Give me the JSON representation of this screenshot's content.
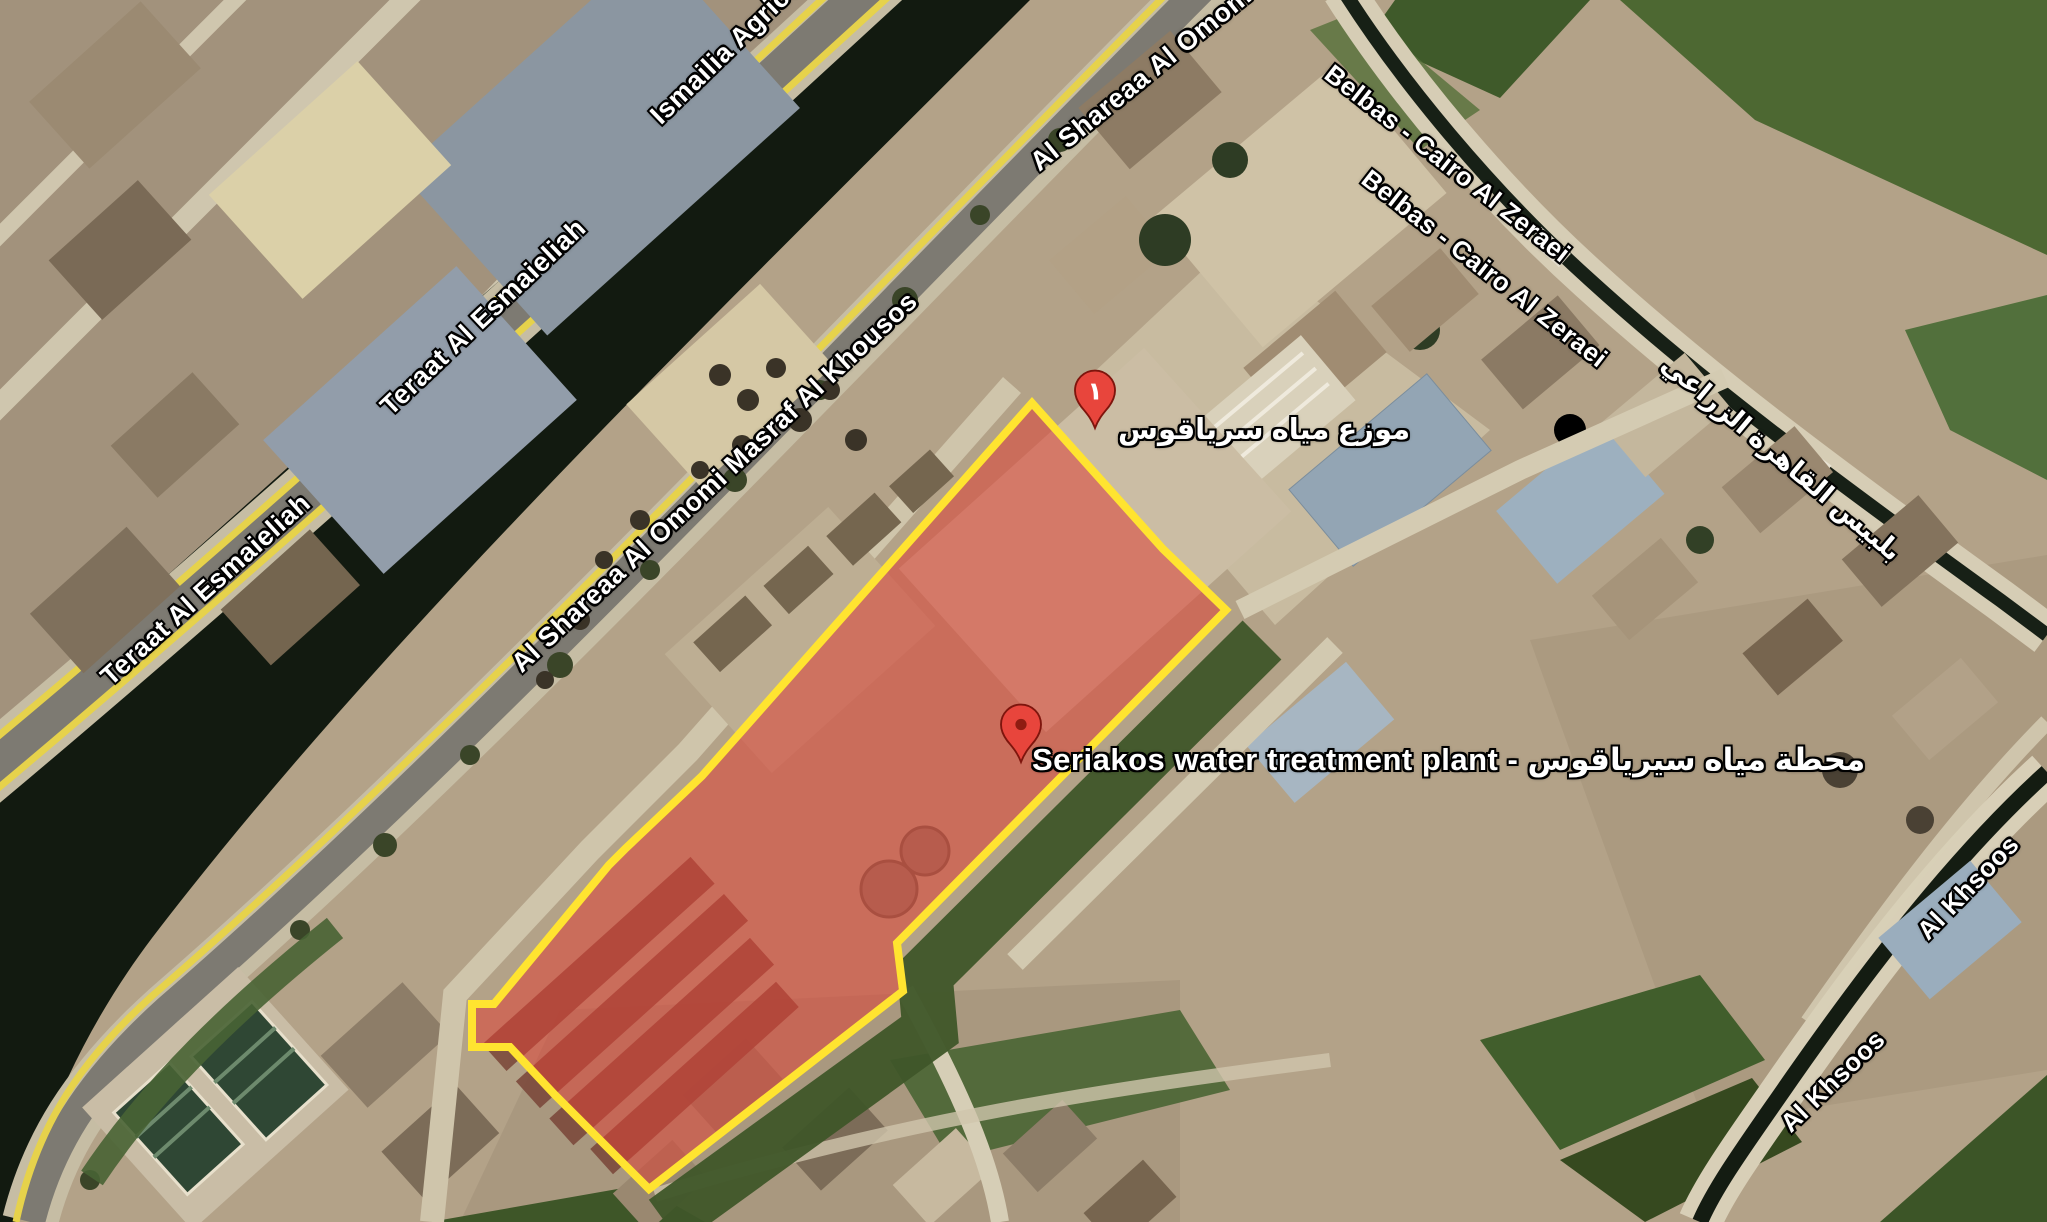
{
  "map": {
    "view": "satellite",
    "place_labels": [
      {
        "text": "Seriakos water treatment plant - محطة مياه سيرياقوس"
      },
      {
        "text": "موزع مياه سرياقوس"
      }
    ],
    "road_labels": [
      {
        "text": "Ismailia Agricul"
      },
      {
        "text": "Teraat Al Esmaieliah"
      },
      {
        "text": "Teraat Al Esmaieliah"
      },
      {
        "text": "Al Shareaa Al Omomi Masraf Al Khousos"
      },
      {
        "text": "Al Shareaa Al Omom"
      },
      {
        "text": "Belbas - Cairo Al Zeraei"
      },
      {
        "text": "Belbas - Cairo Al Zeraei"
      },
      {
        "text": "بلبيس القاهرة الزراعي"
      },
      {
        "text": "Al Khsoos"
      },
      {
        "text": "Al Khsoos"
      }
    ],
    "markers": [
      {
        "name": "distributor-pin",
        "glyph": "١",
        "color": "#e8453c"
      },
      {
        "name": "plant-pin",
        "glyph": "",
        "color": "#e8453c"
      }
    ],
    "highlight": {
      "name": "highlighted-parcel",
      "fill": "#dd4136",
      "fill_opacity": "0.55",
      "stroke": "#ffe430",
      "stroke_width": "8"
    }
  }
}
